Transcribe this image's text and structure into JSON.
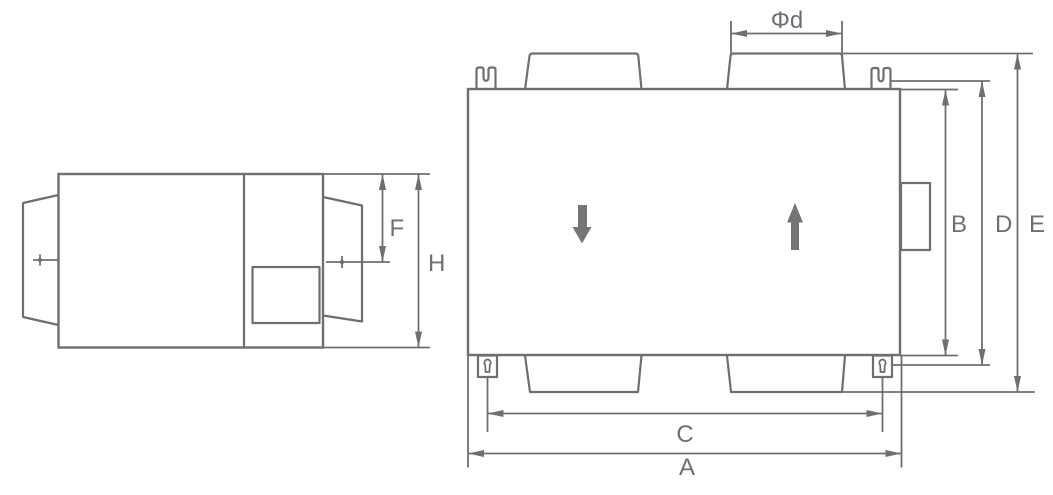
{
  "colors": {
    "line": "#6f6f6f",
    "arrow_fill": "#757575",
    "label": "#6a7078",
    "background": "#ffffff"
  },
  "labels": {
    "phi_d": "Φd",
    "a": "A",
    "b": "B",
    "c": "C",
    "d": "D",
    "e": "E",
    "f": "F",
    "h": "H"
  }
}
